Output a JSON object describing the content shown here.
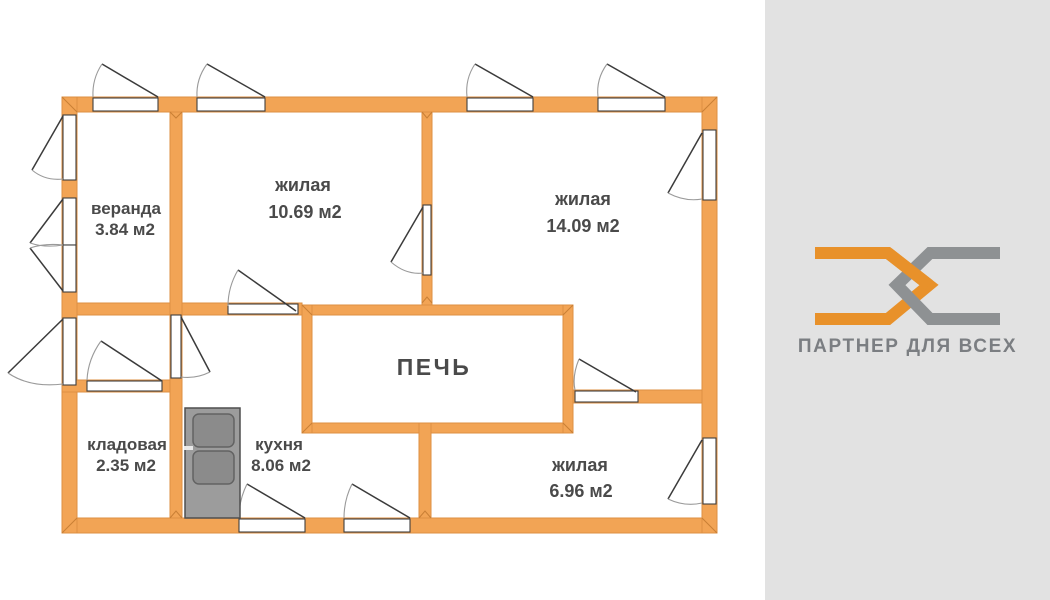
{
  "plan": {
    "rooms": [
      {
        "name": "веранда",
        "area": "3.84 м2"
      },
      {
        "name": "жилая",
        "area": "10.69 м2"
      },
      {
        "name": "жилая",
        "area": "14.09 м2"
      },
      {
        "name": "кладовая",
        "area": "2.35 м2"
      },
      {
        "name": "кухня",
        "area": "8.06 м2"
      },
      {
        "name": "жилая",
        "area": "6.96 м2"
      }
    ],
    "stove_label": "ПЕЧЬ"
  },
  "branding": {
    "logo_text": "ПАРТНЕР ДЛЯ ВСЕХ",
    "logo_orange": "#e8912a",
    "logo_gray": "#8e9193"
  },
  "colors": {
    "wall": "#f2a455",
    "wall_edge": "#dd8f42",
    "panel_bg": "#e2e2e2",
    "label_text": "#4a4a4a",
    "appliance_gray": "#9c9c9c"
  }
}
